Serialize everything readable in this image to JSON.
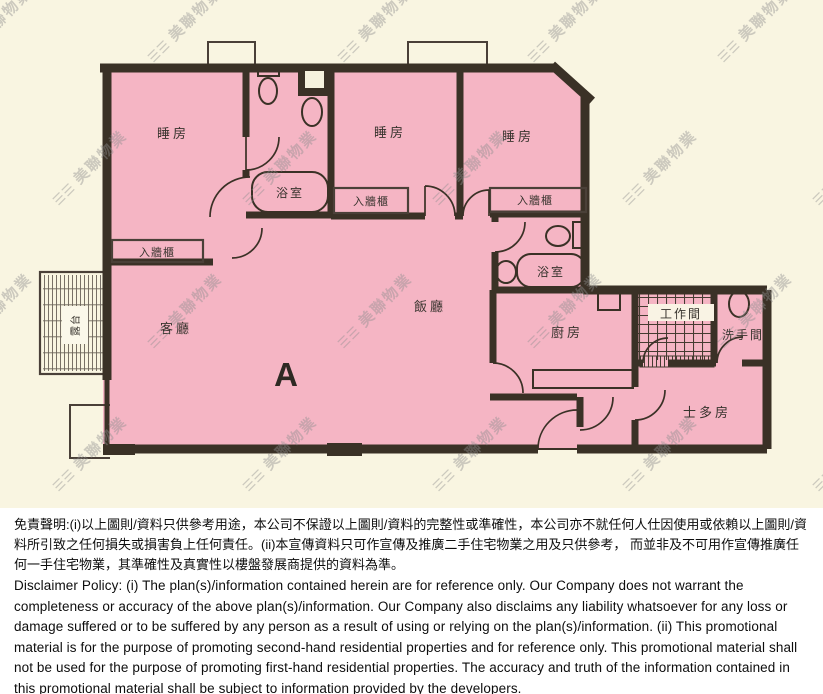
{
  "plan": {
    "unit_label": "A",
    "rooms": {
      "bedroom1": "睡房",
      "bedroom2": "睡房",
      "bedroom3": "睡房",
      "living_room": "客廳",
      "dining_room": "飯廳",
      "kitchen": "廚房",
      "bathroom1": "浴室",
      "bathroom2": "浴室",
      "closet1": "入牆櫃",
      "closet2": "入牆櫃",
      "closet3": "入牆櫃",
      "workroom": "工作間",
      "toilet": "洗手間",
      "storeroom": "士多房",
      "balcony": "露台"
    }
  },
  "watermark": {
    "logo": "☰☰",
    "text": "美聯物業"
  },
  "disclaimer": {
    "chinese": "免責聲明:(i)以上圖則/資料只供參考用途，本公司不保證以上圖則/資料的完整性或準確性，本公司亦不就任何人仕因使用或依賴以上圖則/資料所引致之任何損失或損害負上任何責任。(ii)本宣傳資料只可作宣傳及推廣二手住宅物業之用及只供參考， 而並非及不可用作宣傳推廣任何一手住宅物業，其準確性及真實性以樓盤發展商提供的資料為準。",
    "english": "Disclaimer Policy: (i) The plan(s)/information contained herein are for reference only. Our Company does not warrant the completeness or accuracy of the above plan(s)/information. Our Company also disclaims any liability whatsoever for any loss or damage suffered or to be suffered by any person as a result of using or relying on the plan(s)/information. (ii) This promotional material is for the purpose of promoting second-hand residential properties and for reference only. This promotional material shall not be used for the purpose of promoting first-hand residential properties. The accuracy and truth of the information contained in this promotional material shall be subject to information provided by the developers."
  },
  "colors": {
    "background_cream": "#f9f5e1",
    "room_pink": "#f5b5c4",
    "wall_dark": "#3a3126",
    "watermark_gray": "#8f8f8f",
    "paper_white": "#ffffff"
  }
}
